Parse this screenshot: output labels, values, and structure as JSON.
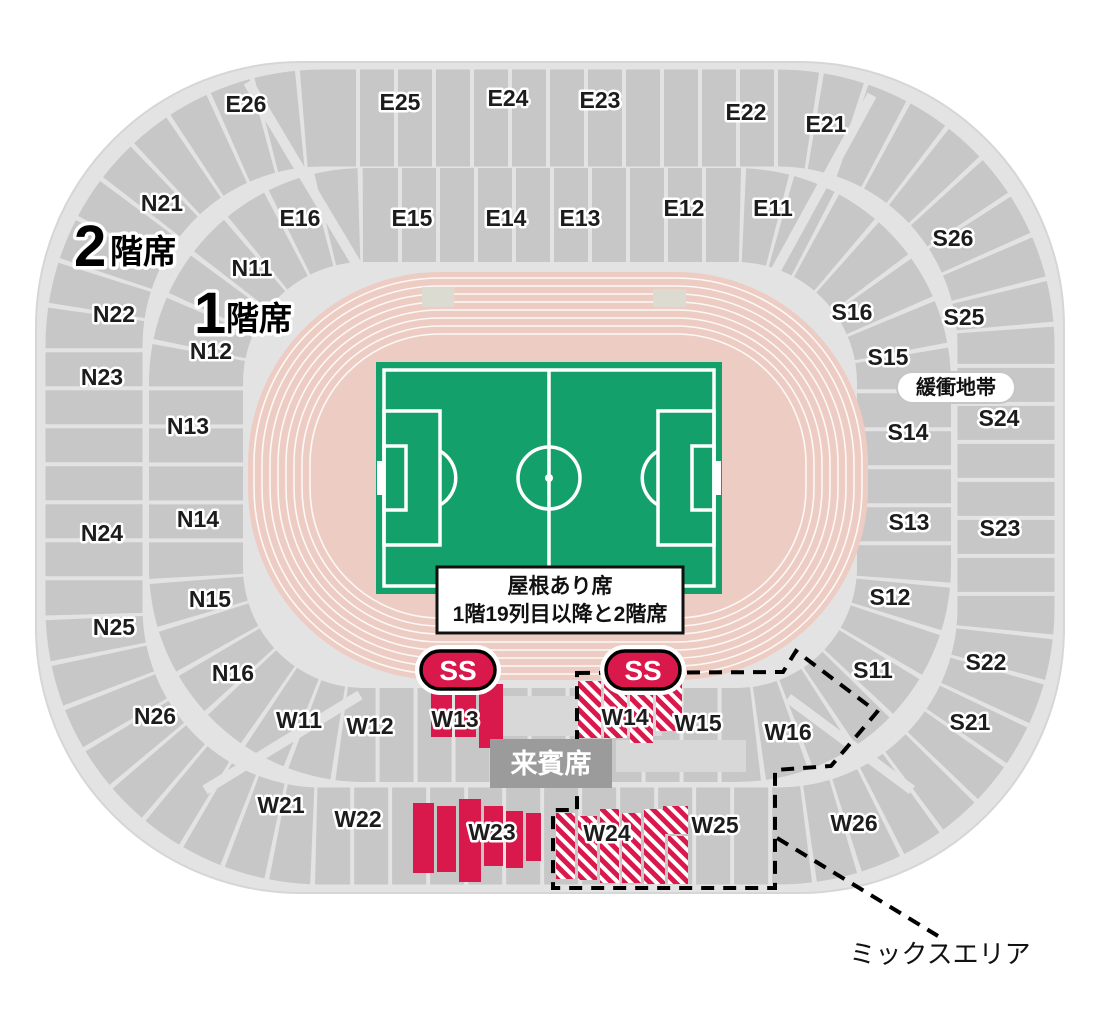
{
  "legend": {
    "tier2_num": "2",
    "tier2_suffix": "階席",
    "tier1_num": "1",
    "tier1_suffix": "階席",
    "roof_note": {
      "line1": "屋根あり席",
      "line2": "1階19列目以降と2階席"
    },
    "buffer_zone": "緩衝地帯",
    "vip_seats": "来賓席",
    "mix_area": "ミックスエリア",
    "ss_badge": "SS"
  },
  "sections": {
    "east_upper": [
      "E26",
      "E25",
      "E24",
      "E23",
      "E22",
      "E21"
    ],
    "east_lower": [
      "E16",
      "E15",
      "E14",
      "E13",
      "E12",
      "E11"
    ],
    "north_upper": [
      "N21",
      "N22",
      "N23",
      "N24",
      "N25",
      "N26"
    ],
    "north_lower": [
      "N11",
      "N12",
      "N13",
      "N14",
      "N15",
      "N16"
    ],
    "south_upper": [
      "S26",
      "S25",
      "S24",
      "S23",
      "S22",
      "S21"
    ],
    "south_lower": [
      "S16",
      "S15",
      "S14",
      "S13",
      "S12",
      "S11"
    ],
    "west_lower": [
      "W11",
      "W12",
      "W13",
      "W14",
      "W15",
      "W16"
    ],
    "west_upper": [
      "W21",
      "W22",
      "W23",
      "W24",
      "W25",
      "W26"
    ]
  },
  "colors": {
    "base": "#e3e3e3",
    "section": "#c7c7c7",
    "track": "#edccc3",
    "pitch": "#14a06b",
    "red": "#d9184b",
    "vip": "#9b9b9b",
    "ink": "#1c1c1c",
    "subrow": "#d8d8d8",
    "trackblock": "#dbdbd2"
  }
}
